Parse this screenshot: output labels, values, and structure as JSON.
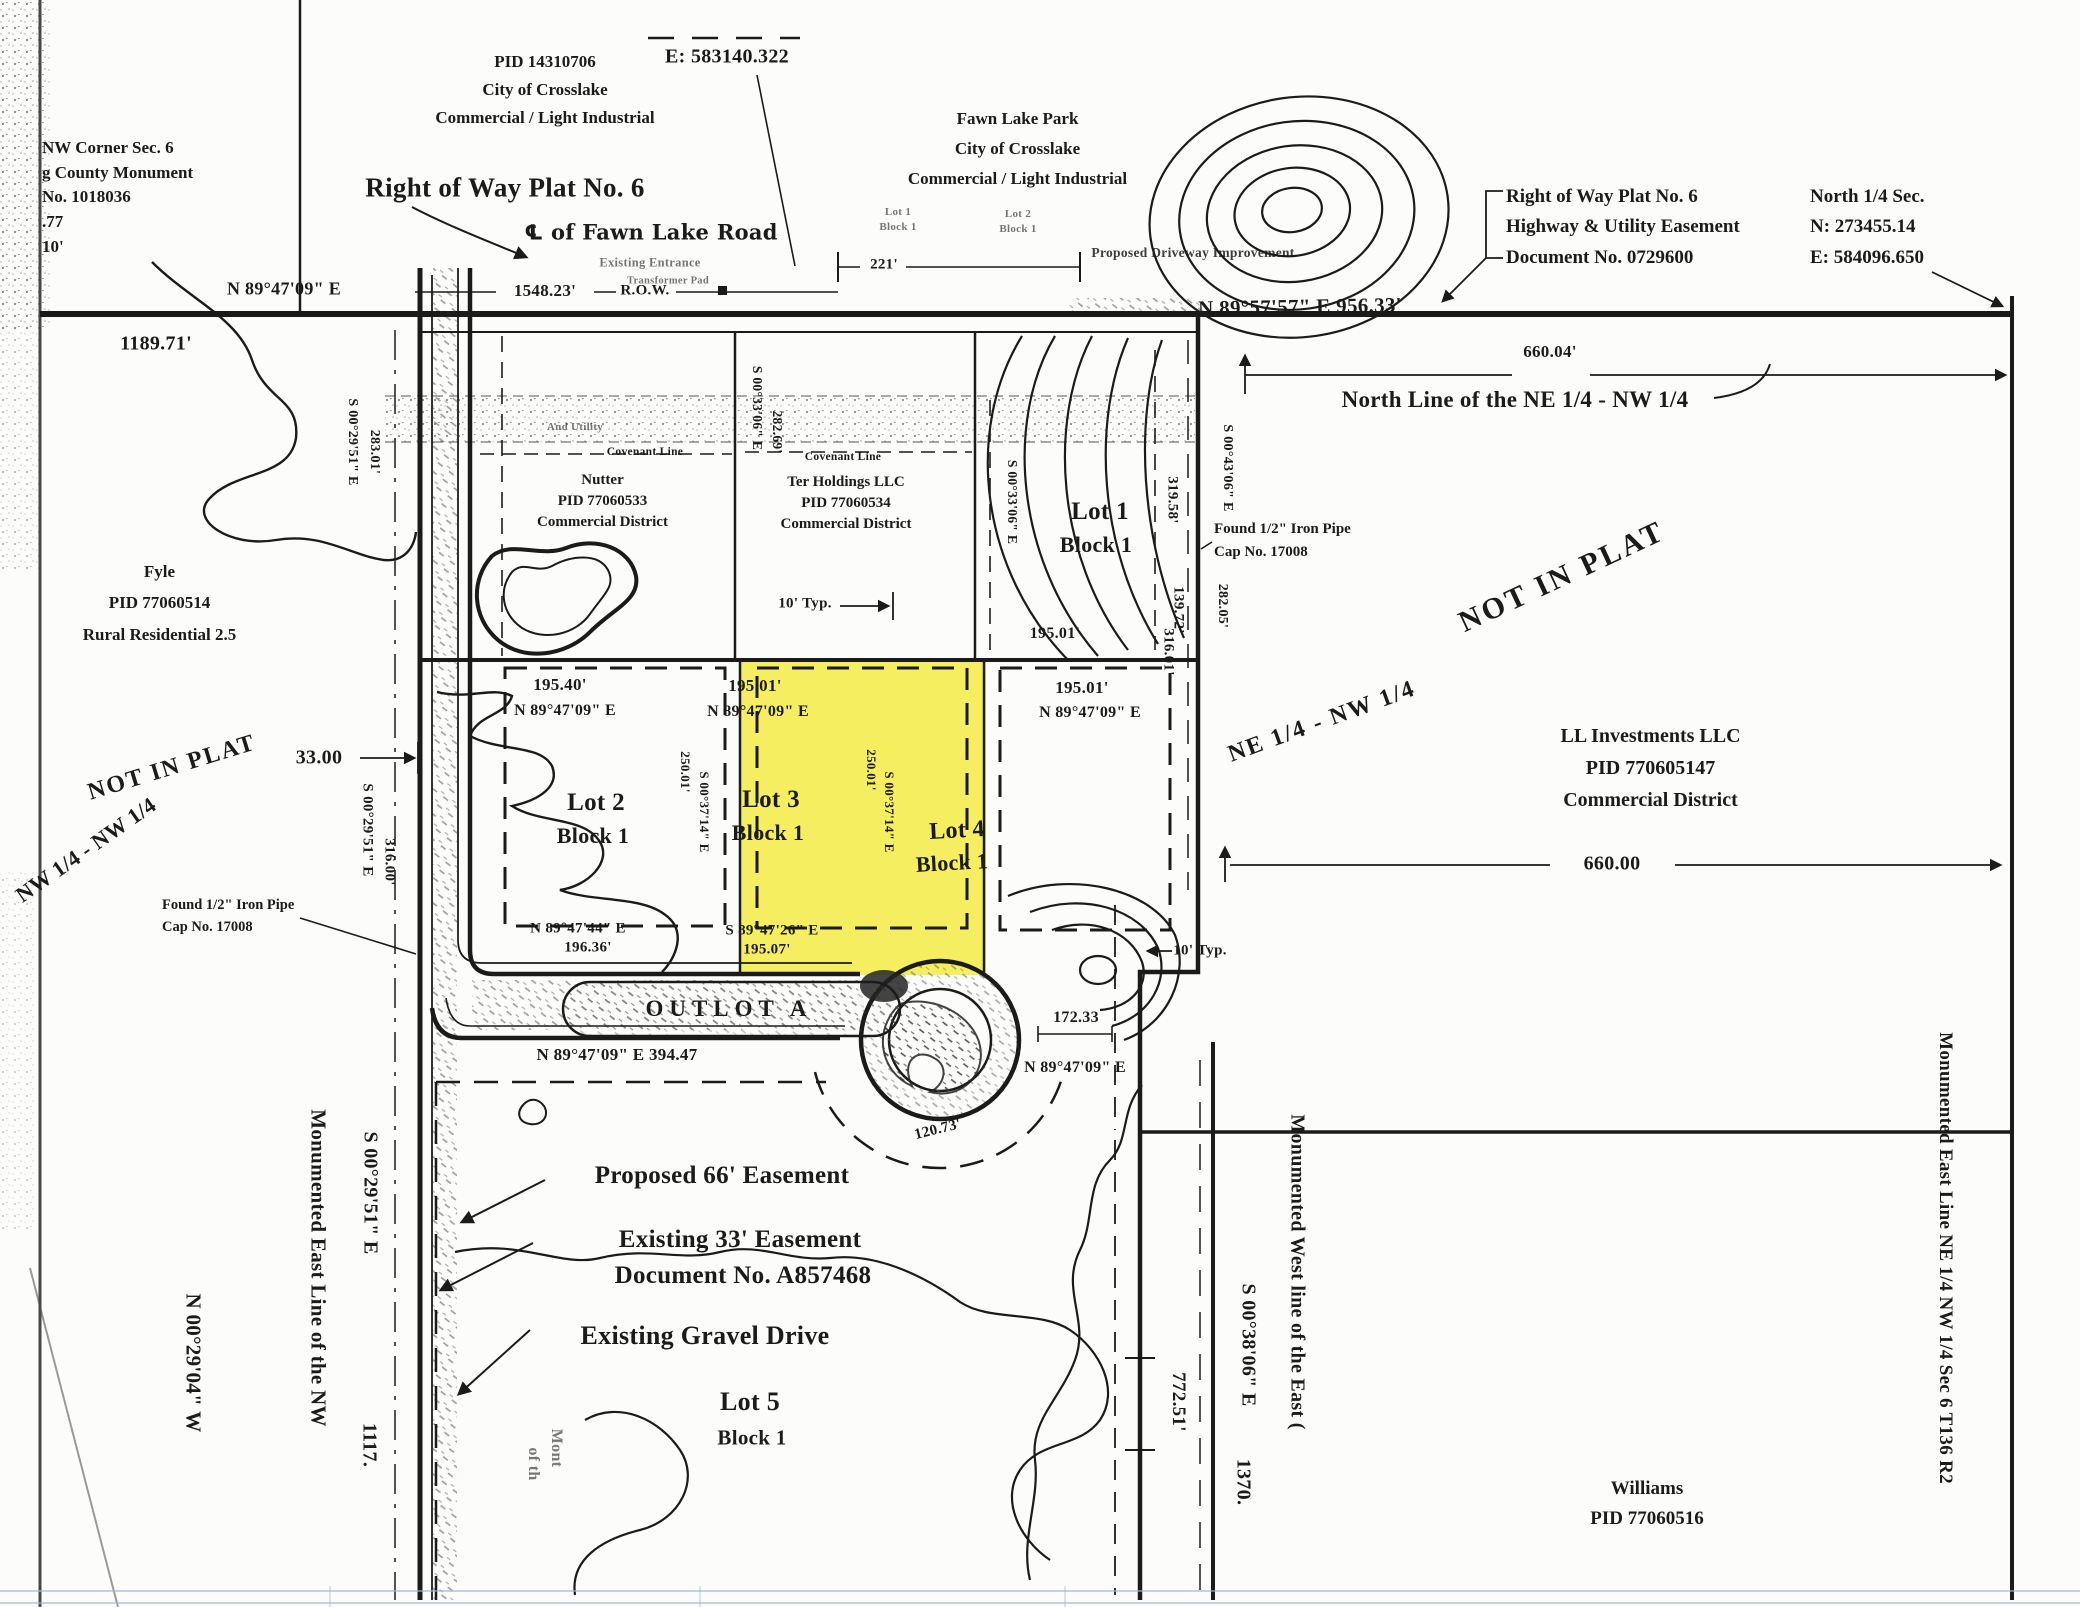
{
  "title_left": "Right of Way Plat No. 6",
  "corner_nw": {
    "l1": "NW Corner Sec. 6",
    "l2": "g County Monument",
    "l3": "No. 1018036",
    "l4": ".77",
    "l5": "10'"
  },
  "parcel_nw": {
    "pid": "PID 14310706",
    "city": "City of Crosslake",
    "zone": "Commercial / Light Industrial",
    "coord": "E: 583140.322"
  },
  "road_top": {
    "centerline": "℄ of Fawn Lake Road",
    "entrance": "Existing Entrance",
    "dim": "1548.23'",
    "row": "R.O.W.",
    "bearing_w": "N 89°47'09\" E",
    "dim_w": "1189.71'",
    "dim_221": "221'",
    "bearing_e": "N 89°57'57\" E  956.33'",
    "driveway": "Proposed Driveway Improvement"
  },
  "fawn_lake_park": {
    "name": "Fawn Lake Park",
    "city": "City of Crosslake",
    "zone": "Commercial / Light Industrial",
    "lot1": "Lot 1",
    "block1": "Block 1",
    "lot2": "Lot 2",
    "block2": "Block 1"
  },
  "row_note": {
    "l1": "Right of Way Plat No. 6",
    "l2": "Highway & Utility Easement",
    "l3": "Document No. 0729600"
  },
  "north_quarter": {
    "l1": "North 1/4  Sec.",
    "l2": "N: 273455.14",
    "l3": "E: 584096.650"
  },
  "north_line": {
    "dim": "660.04'",
    "label": "North Line of the NE 1/4 - NW 1/4"
  },
  "band": {
    "utility": "And Utility",
    "transformer": "Transformer Pad"
  },
  "covenant_left": "Covenant Line",
  "covenant_right": "Covenant Line",
  "nutter": {
    "name": "Nutter",
    "pid": "PID 77060533",
    "zone": "Commercial District"
  },
  "ter": {
    "name": "Ter Holdings LLC",
    "pid": "PID 77060534",
    "zone": "Commercial District"
  },
  "fyle": {
    "name": "Fyle",
    "pid": "PID 77060514",
    "zone": "Rural Residential 2.5"
  },
  "lots": {
    "lot1": "Lot 1",
    "lot2": "Lot 2",
    "lot3": "Lot 3",
    "lot4": "Lot 4",
    "lot5": "Lot 5",
    "block": "Block 1"
  },
  "not_in_plat_left": "NOT IN PLAT",
  "not_in_plat_right": "NOT IN PLAT",
  "quarter_left": "NW 1/4 - NW 1/4",
  "quarter_right": "NE 1/4 - NW 1/4",
  "ll": {
    "name": "LL Investments LLC",
    "pid": "PID 770605147",
    "zone": "Commercial District"
  },
  "outlot": "OUTLOT A",
  "found_left": {
    "l1": "Found 1/2\" Iron Pipe",
    "l2": "Cap No. 17008"
  },
  "found_right": {
    "l1": "Found 1/2\" Iron Pipe",
    "l2": "Cap No. 17008"
  },
  "easements": {
    "e66": "Proposed 66' Easement",
    "e33": "Existing 33' Easement",
    "doc": "Document No. A857468",
    "gravel": "Existing Gravel Drive"
  },
  "edge_left": {
    "mon": "Monumented East Line of the NW",
    "b": "S 00°29'51\" E",
    "d": "1117.",
    "b2": "N 00°29'04\" W",
    "p1": "Mont",
    "p2": "of th"
  },
  "edge_right_inner": {
    "mon": "Monumented West line of the East (",
    "b": "S 00°38'06\" E",
    "d": "1370."
  },
  "edge_right": {
    "mon": "Monumented East Line NE 1/4  NW 1/4 Sec 6 T136 R2"
  },
  "williams": {
    "name": "Williams",
    "pid": "PID 77060516"
  },
  "dims": {
    "d660": "660.00",
    "d33": "33.00",
    "v283b": "S 00°29'51\" E",
    "v283": "283.01'",
    "v316b": "S 00°29'51\" E",
    "v316": "316.00'",
    "v282_69b": "S 00°33'06\" E",
    "v282_69": "282.69'",
    "lot1w_b": "S 00°33'06\" E",
    "v319": "319.58'",
    "v139": "139.72'",
    "v282_05b": "S 00°43'06\" E",
    "v282_05": "282.05'",
    "typ10": "10' Typ.",
    "lot1_s": "195.01'",
    "lot2_n": "195.40'",
    "lot2_nb": "N 89°47'09\" E",
    "lot3_n": "195.01'",
    "lot3_nb": "N 89°47'09\" E",
    "lot4_n": "195.01'",
    "lot4_nb": "N 89°47'09\" E",
    "lot2_sb": "N 89°47'44\" E",
    "lot2_s": "196.36'",
    "lot3_sb": "S 89°47'26\" E",
    "lot3_s": "195.07'",
    "v250w": "250.01'",
    "v250wb": "S 00°37'14\" E",
    "v250e": "250.01'",
    "v250eb": "S 00°37'14\" E",
    "v316_01": "316.01'",
    "d172": "172.33",
    "cul_b": "N 89°47'09\" E",
    "arc120": "120.73'",
    "d394": "N 89°47'09\" E  394.47",
    "d772": "772.51'"
  }
}
